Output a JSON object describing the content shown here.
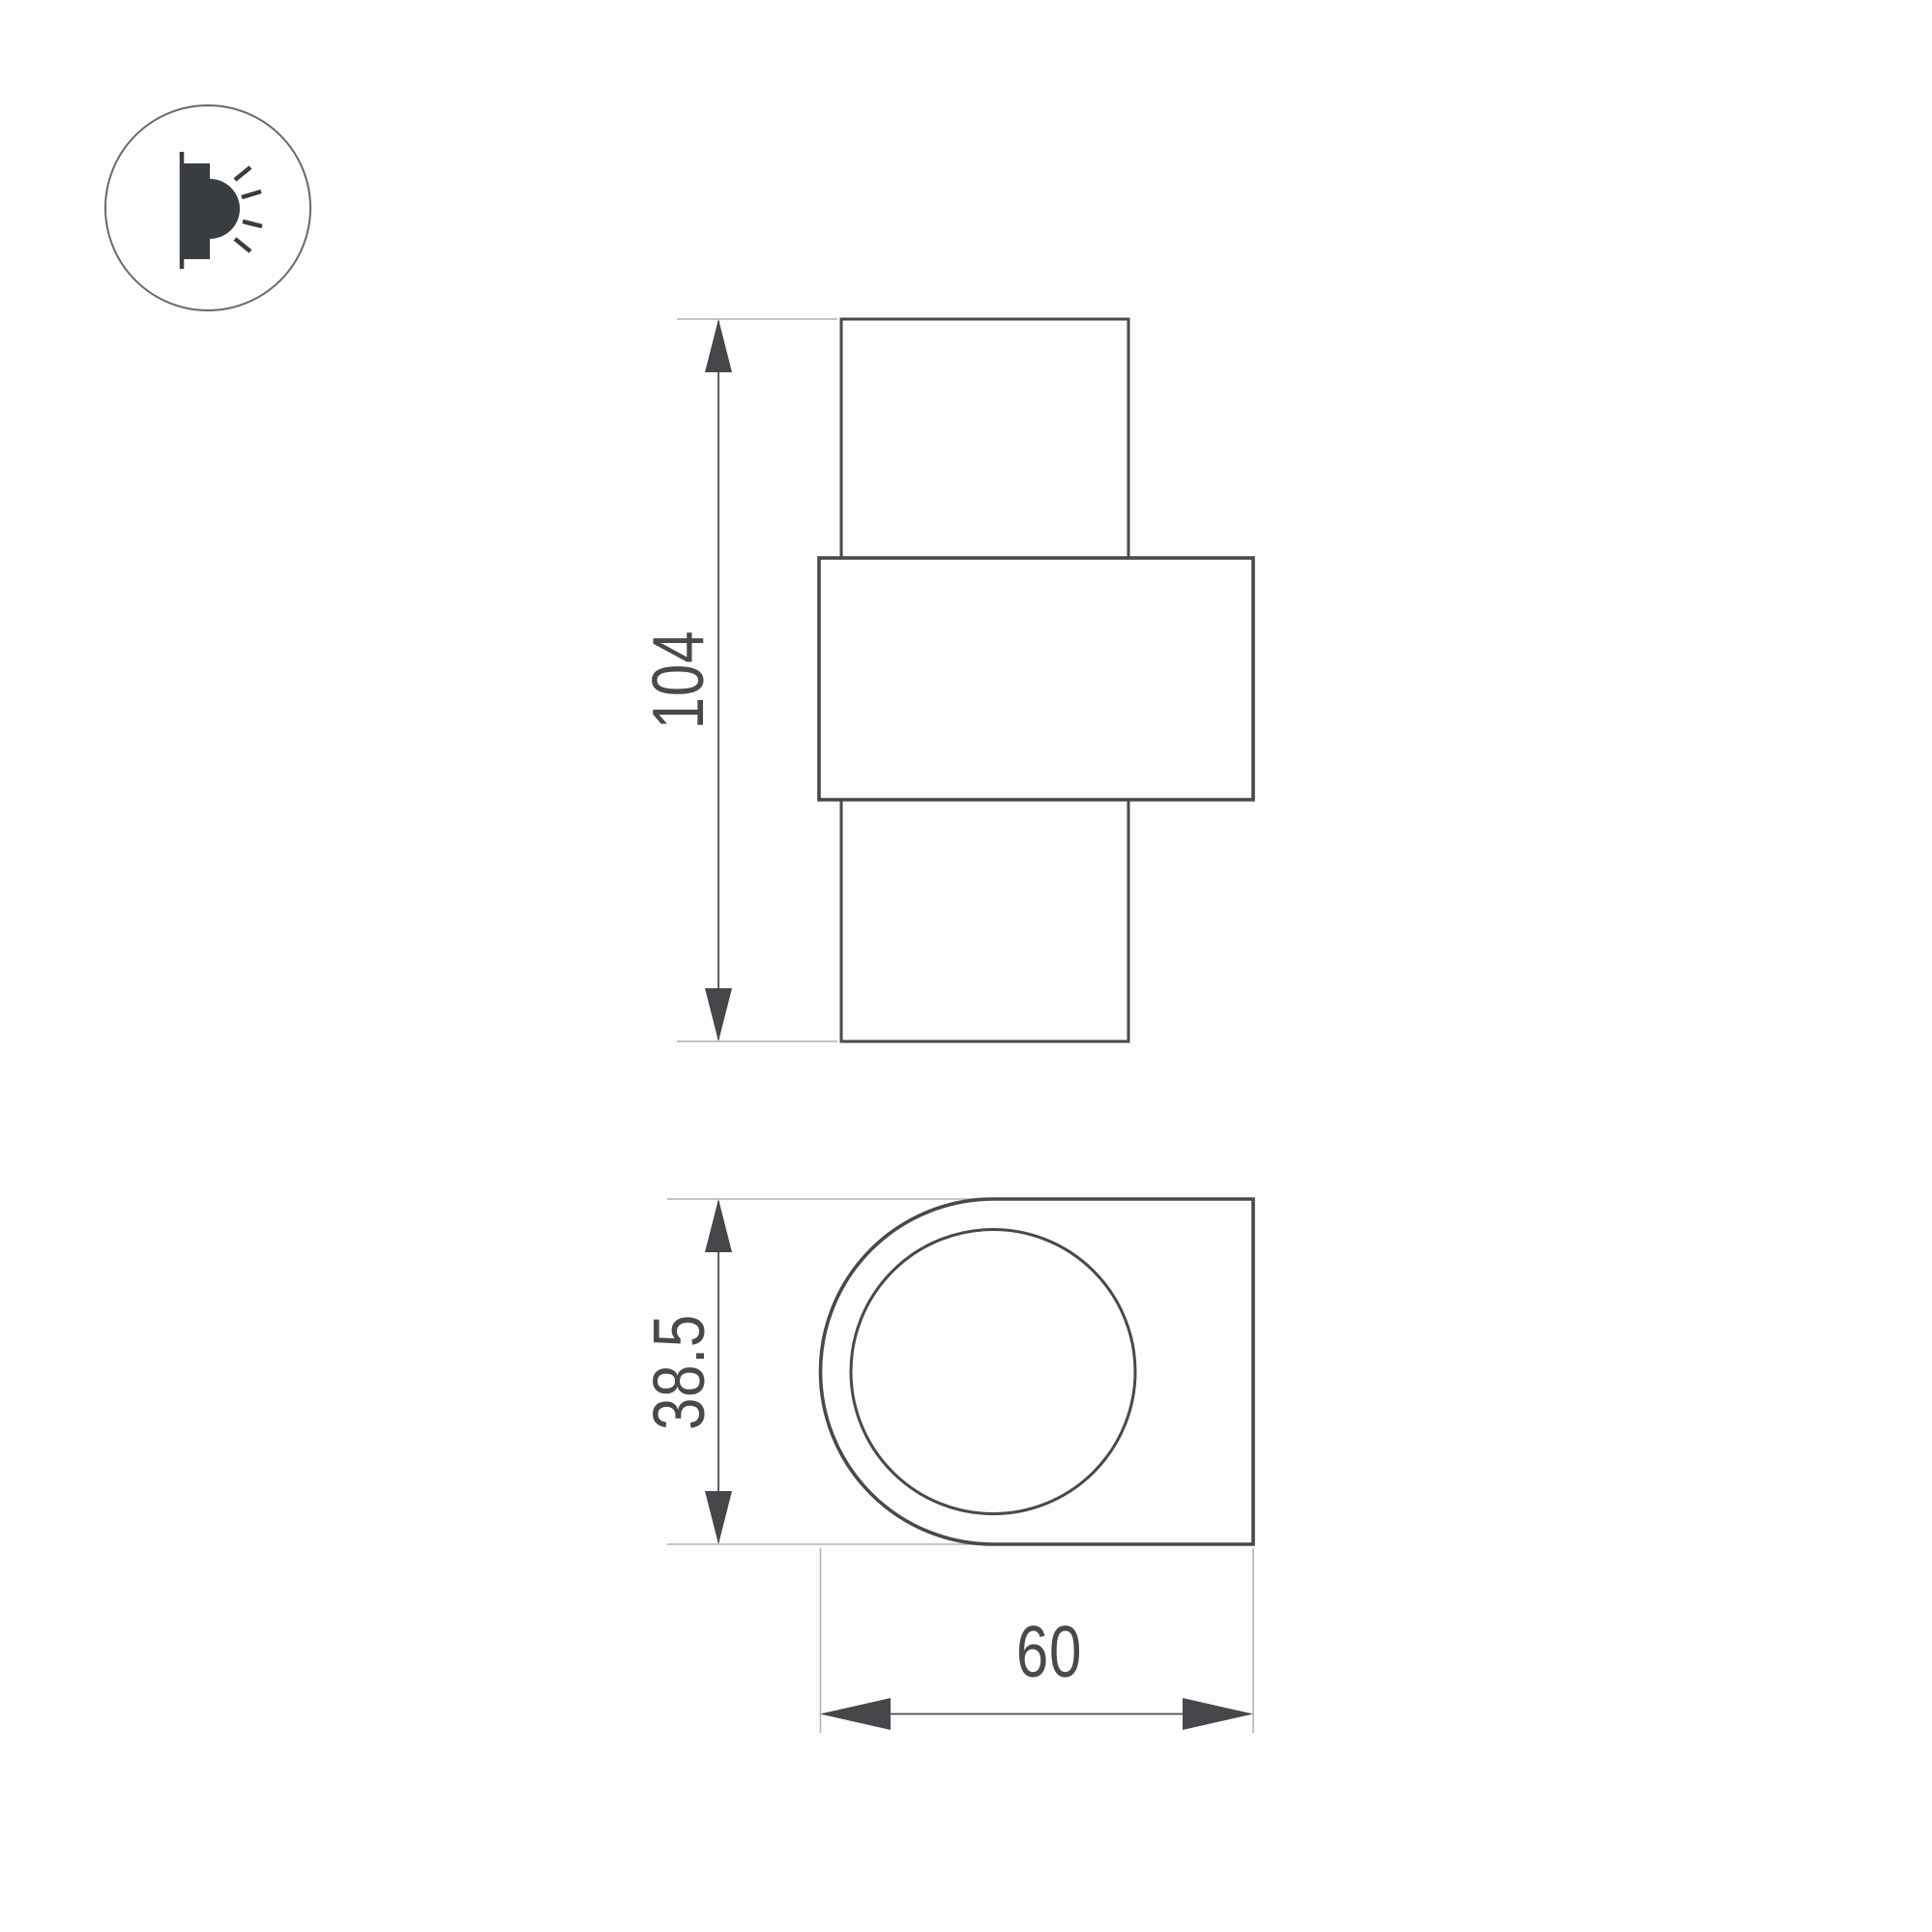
{
  "title": "wall-lamp-technical-dimension-drawing",
  "icon": {
    "name": "wall-light-icon",
    "description": "circled pictogram of a wall-mounted lamp emitting light rays"
  },
  "views": {
    "front_view": {
      "name": "front-elevation",
      "height_label": "104"
    },
    "side_view": {
      "name": "side-profile",
      "height_label": "38.5",
      "width_label": "60"
    }
  },
  "labels": {
    "front_height": "104",
    "side_height": "38.5",
    "side_width": "60"
  },
  "colors": {
    "background": "#fdfdfe",
    "outline": "#47494c",
    "dimension_line": "#4c4e50",
    "extension_line": "#b0b2b4",
    "arrow_fill": "#45474a",
    "text": "#48494b",
    "icon_glyph": "#3a3d40",
    "icon_ring": "#67696c"
  }
}
